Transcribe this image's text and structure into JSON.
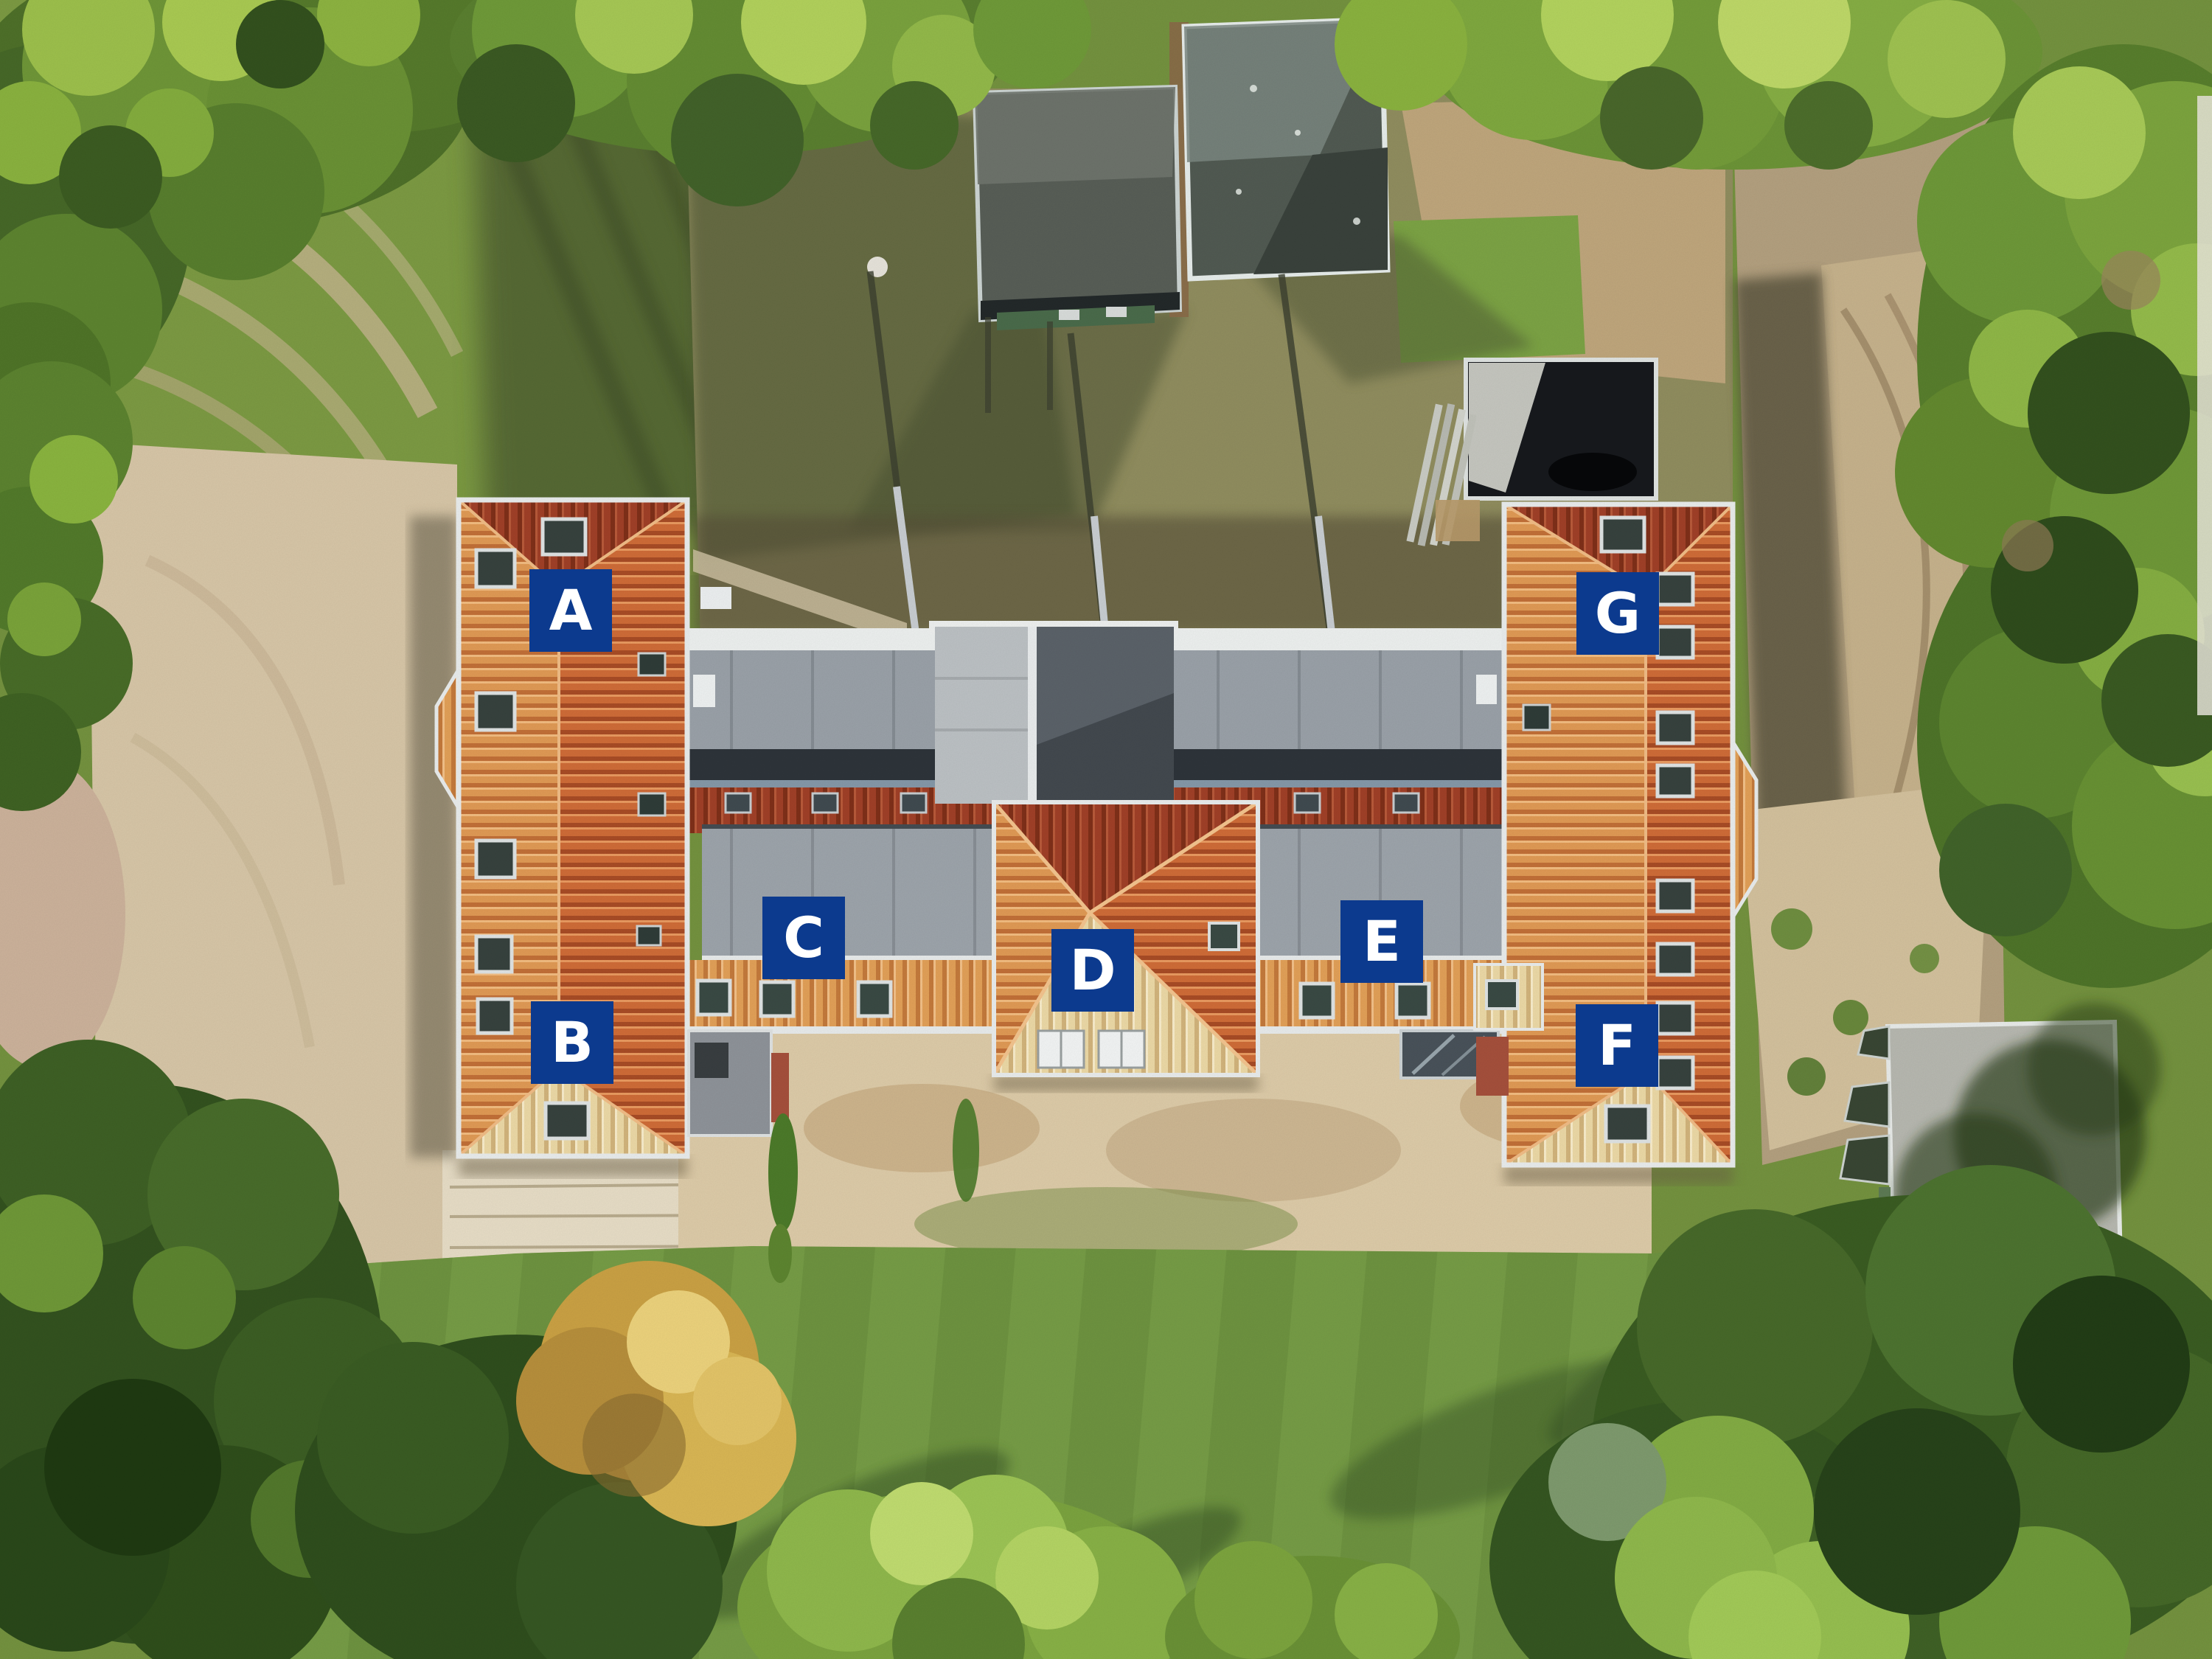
{
  "photo": {
    "kind": "aerial-top-down-drone-photo",
    "subject": "U-shaped residential building complex with orange tiled roofs among trees, sand and lawn"
  },
  "overlay": {
    "units": [
      {
        "letter": "A"
      },
      {
        "letter": "B"
      },
      {
        "letter": "C"
      },
      {
        "letter": "D"
      },
      {
        "letter": "E"
      },
      {
        "letter": "F"
      },
      {
        "letter": "G"
      }
    ],
    "label_background": "#0c3a8e",
    "label_text_color": "#ffffff"
  },
  "palette": {
    "roof_tile_golden": "#e09a55",
    "roof_tile_orange": "#cf6c38",
    "roof_tile_dark_red": "#a04028",
    "roof_tile_cream": "#ecd9a6",
    "flat_roof_gray": "#9da4ab",
    "shed_roof_gray": "#585e57",
    "annex_glass_dark": "#17191d",
    "sand": "#d7c6a7",
    "dirt": "#b3a07f",
    "grass": "#74923f",
    "tree_dark": "#33521f",
    "tree_light": "#9dc04c"
  }
}
